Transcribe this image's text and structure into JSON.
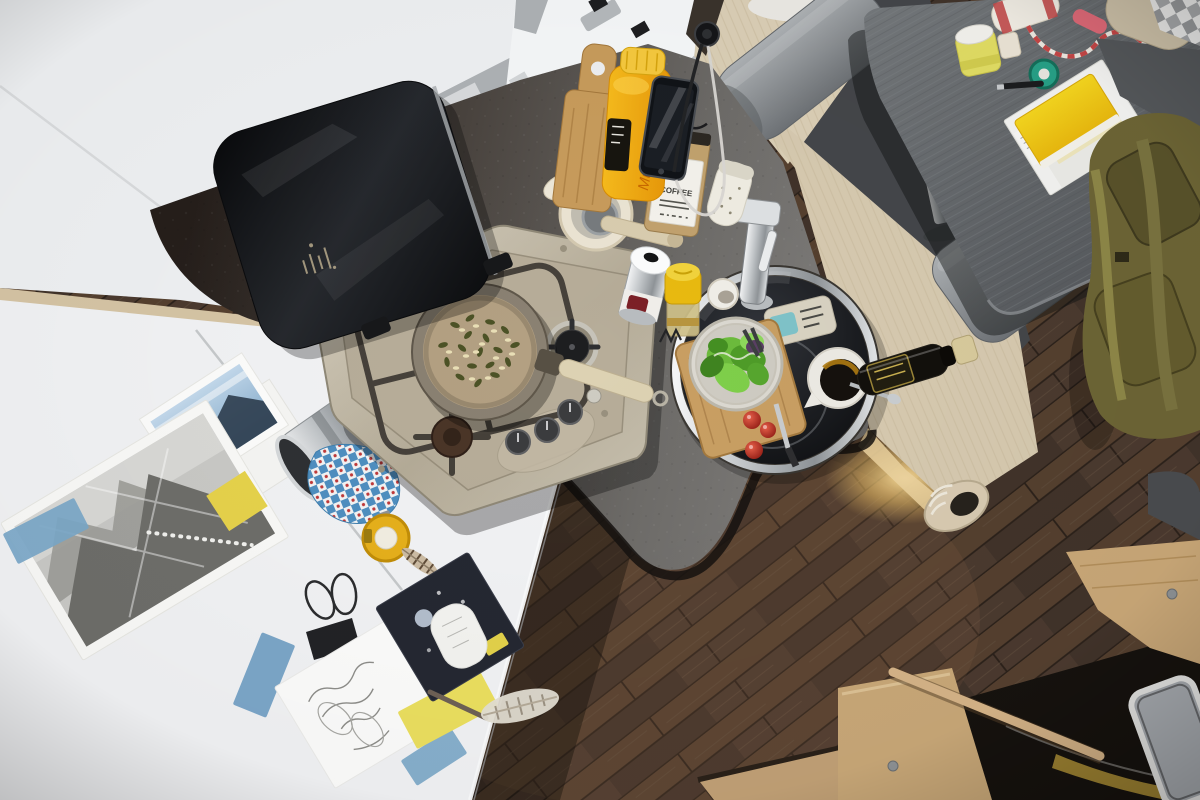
{
  "scene": {
    "type": "photograph",
    "setting": "Overhead view of a motorhome camper kitchen and dinette while cooking",
    "regions": {
      "kitchen": [
        "two-burner stainless gas hob with cast-iron pan supports",
        "frying pan toasting pumpkin seeds and pine nuts",
        "raised black glass hob lid",
        "round black sink with chrome rim and faucet",
        "salad bowl with lettuce on wooden chopping board",
        "cherry tomatoes",
        "white jug with olive oil and spoon",
        "olive oil bottle",
        "mortar with wooden pestle",
        "coffee bag",
        "speckled spice shaker",
        "cream spray can",
        "mustard jar",
        "small white cup",
        "standing wooden chopping board",
        "orange juice bottle",
        "smartphone charging at a 12V socket"
      ],
      "dinette": [
        "dark grey dining table on chrome pedestal",
        "grey roll headrest cushions",
        "light wood bench panels with warm LED glow",
        "grey seat cushion",
        "olive green backpack",
        "beige and checkered cushions",
        "twine spool with red-white cord",
        "storage jar",
        "green tape roll",
        "pen",
        "yellow and white notebooks"
      ],
      "craft_desk": [
        "white worktop",
        "black-and-white mountain photograph",
        "landscape photo print",
        "handwritten calligraphy card",
        "dark illustrated postcard",
        "binder clip",
        "blue masking tape pieces",
        "yellow sticky note",
        "stainless pitcher",
        "blue checked tea towel",
        "yellow tape measure",
        "feathers",
        "knitting needle",
        "pencil"
      ],
      "floor_entry": [
        "dark wood plank floor",
        "beige sneaker",
        "oak entry step",
        "wooden grab rail",
        "entry door with window"
      ]
    }
  },
  "labels": {
    "coffee_bag": "COFFEE",
    "juice_bottle": "Muesli"
  },
  "palette": {
    "desk": "#f2f3f5",
    "cabinet": "#eff1f3",
    "backpack_olive": "#6d6535",
    "floor_base": "#4b3a2f",
    "counter_dark": "#261f1b",
    "counter_light": "#807e7c",
    "table_gray": "#5f6366",
    "bench_wood": "#dbcfb6",
    "cushion_gray": "#8c9093",
    "stove_steel": "#c6bfae",
    "sink_black": "#121315",
    "lettuce_green": "#5aa832",
    "tomato_red": "#c8281e",
    "juice_yellow": "#f2a90d",
    "tape_measure_yellow": "#e6b01b",
    "glow_warm": "#f7c96b",
    "cloth_blue": "#4f8fc0",
    "notebook_yellow": "#f2cf1f",
    "tape_green": "#27a187",
    "string_red": "#c54646"
  }
}
